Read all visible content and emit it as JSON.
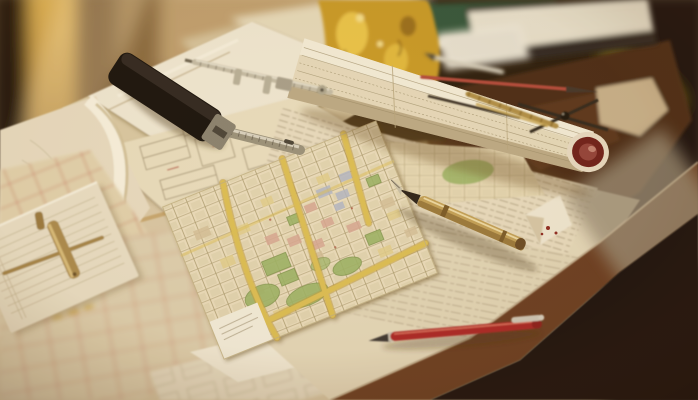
{
  "meta": {
    "type": "photograph",
    "description": "Warmly lit drafting desk covered with overlapping city maps and technical drawings, a rolled plan tube with a maroon end, a brass fountain pen, a red pen, a black marking gauge with steel rule, calipers, dividers, pencils, a clipped note pad, books and a brass ornament on a dark wooden table"
  },
  "palette": {
    "bg-dark": "#140d07",
    "bg-gold": "#d8a84c",
    "bg-brown": "#5e3d1f",
    "table-wood": "#4a2a15",
    "table-band": "#6a3c20",
    "table-sheen": "#9a8c76",
    "paper-white": "#f0e8d4",
    "paper-cream": "#e6dabc",
    "paper-tan": "#d9c9a4",
    "map-cream": "#eaddbd",
    "map-road-yellow": "#ddbf55",
    "map-park-green": "#9db467",
    "map-block-pink": "#d8a894",
    "map-block-blue": "#b4b8c6",
    "map-block-yellow": "#e2cf8e",
    "map-block-tan": "#d4c09a",
    "map-line-olive": "#a39365",
    "red-ink": "#bc5a48",
    "tool-black": "#17110c",
    "metal-silver": "#cfc8b2",
    "brass": "#c2a158",
    "brass-bright": "#edc94e",
    "pen-red": "#ab2626",
    "tube-cap-maroon": "#6e1e1a",
    "pencil-tip-dark": "#3a3430",
    "book-green": "#33543a",
    "page-white": "#ece6d4"
  },
  "scene": {
    "objects": [
      {
        "id": "city-map",
        "label": "colored city street map with yellow roads and green parks"
      },
      {
        "id": "rolled-plan-tube",
        "label": "rolled ledger plan with maroon end cap"
      },
      {
        "id": "fountain-pen",
        "label": "brass fountain pen pointing at map"
      },
      {
        "id": "red-pen",
        "label": "red pen with metal clip"
      },
      {
        "id": "marking-gauge",
        "label": "black marking gauge with steel rule"
      },
      {
        "id": "caliper",
        "label": "steel sliding caliper"
      },
      {
        "id": "divider-compass",
        "label": "drafting dividers"
      },
      {
        "id": "brass-pencil",
        "label": "brass pencil"
      },
      {
        "id": "silver-pen",
        "label": "silver pen"
      },
      {
        "id": "red-pencil",
        "label": "red pencil"
      },
      {
        "id": "note-pad",
        "label": "note pad with brass wire clip"
      },
      {
        "id": "sketch-sheets",
        "label": "pencil-drawn plan sheets"
      },
      {
        "id": "red-line-maps",
        "label": "map sheets with red street lines"
      },
      {
        "id": "books",
        "label": "green book and thick white-paged book"
      },
      {
        "id": "brass-ornament",
        "label": "ornate brass desk ornament"
      },
      {
        "id": "wood-table",
        "label": "dark wooden table edge"
      }
    ]
  }
}
